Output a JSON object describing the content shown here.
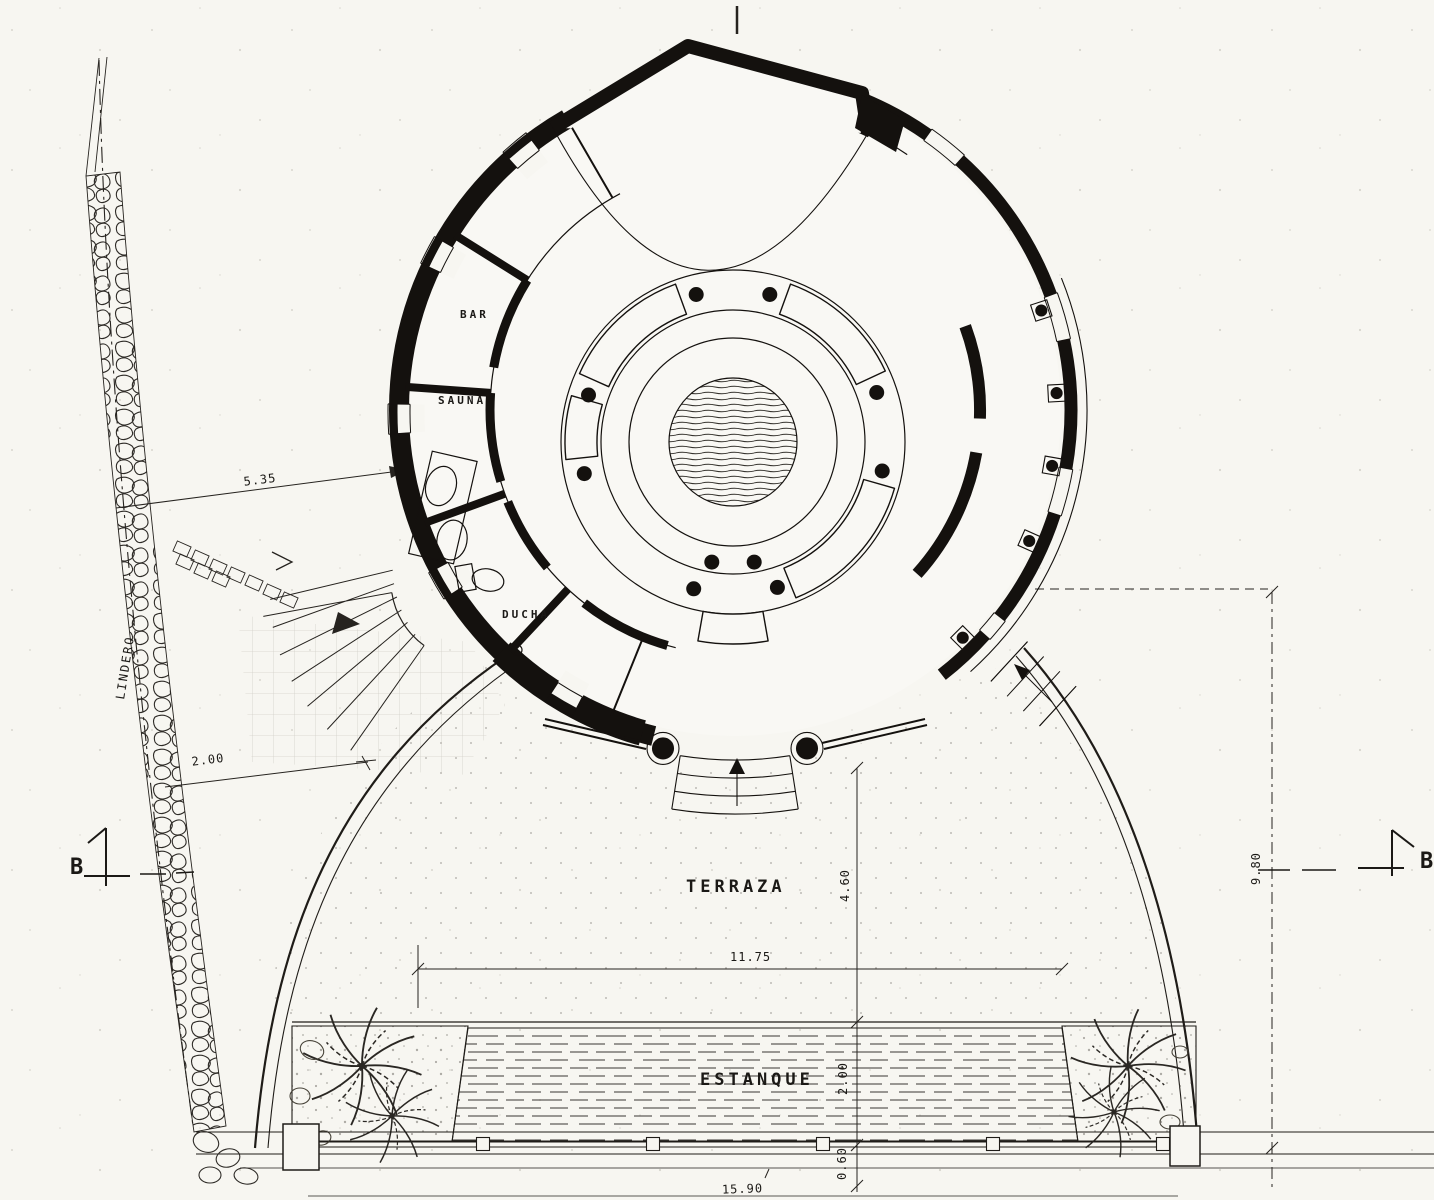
{
  "plan": {
    "rooms": {
      "bar": "BAR",
      "sauna": "SAUNA",
      "ducha": "DUCHA"
    },
    "areas": {
      "terraza": "TERRAZA",
      "estanque": "ESTANQUE"
    },
    "site": {
      "boundary": "LINDERO"
    },
    "dimensions": {
      "wall_to_building": "5.35",
      "path_width": "2.00",
      "pond_length": "11.75",
      "terrace_depth": "4.60",
      "pond_width": "2.00",
      "pond_edge": "0.60",
      "right_height": "9.80",
      "overall_width": "15.90"
    },
    "sections": {
      "left": "B",
      "right": "B"
    },
    "colors": {
      "ink": "#1b1916",
      "paper": "#f7f6f1"
    }
  }
}
